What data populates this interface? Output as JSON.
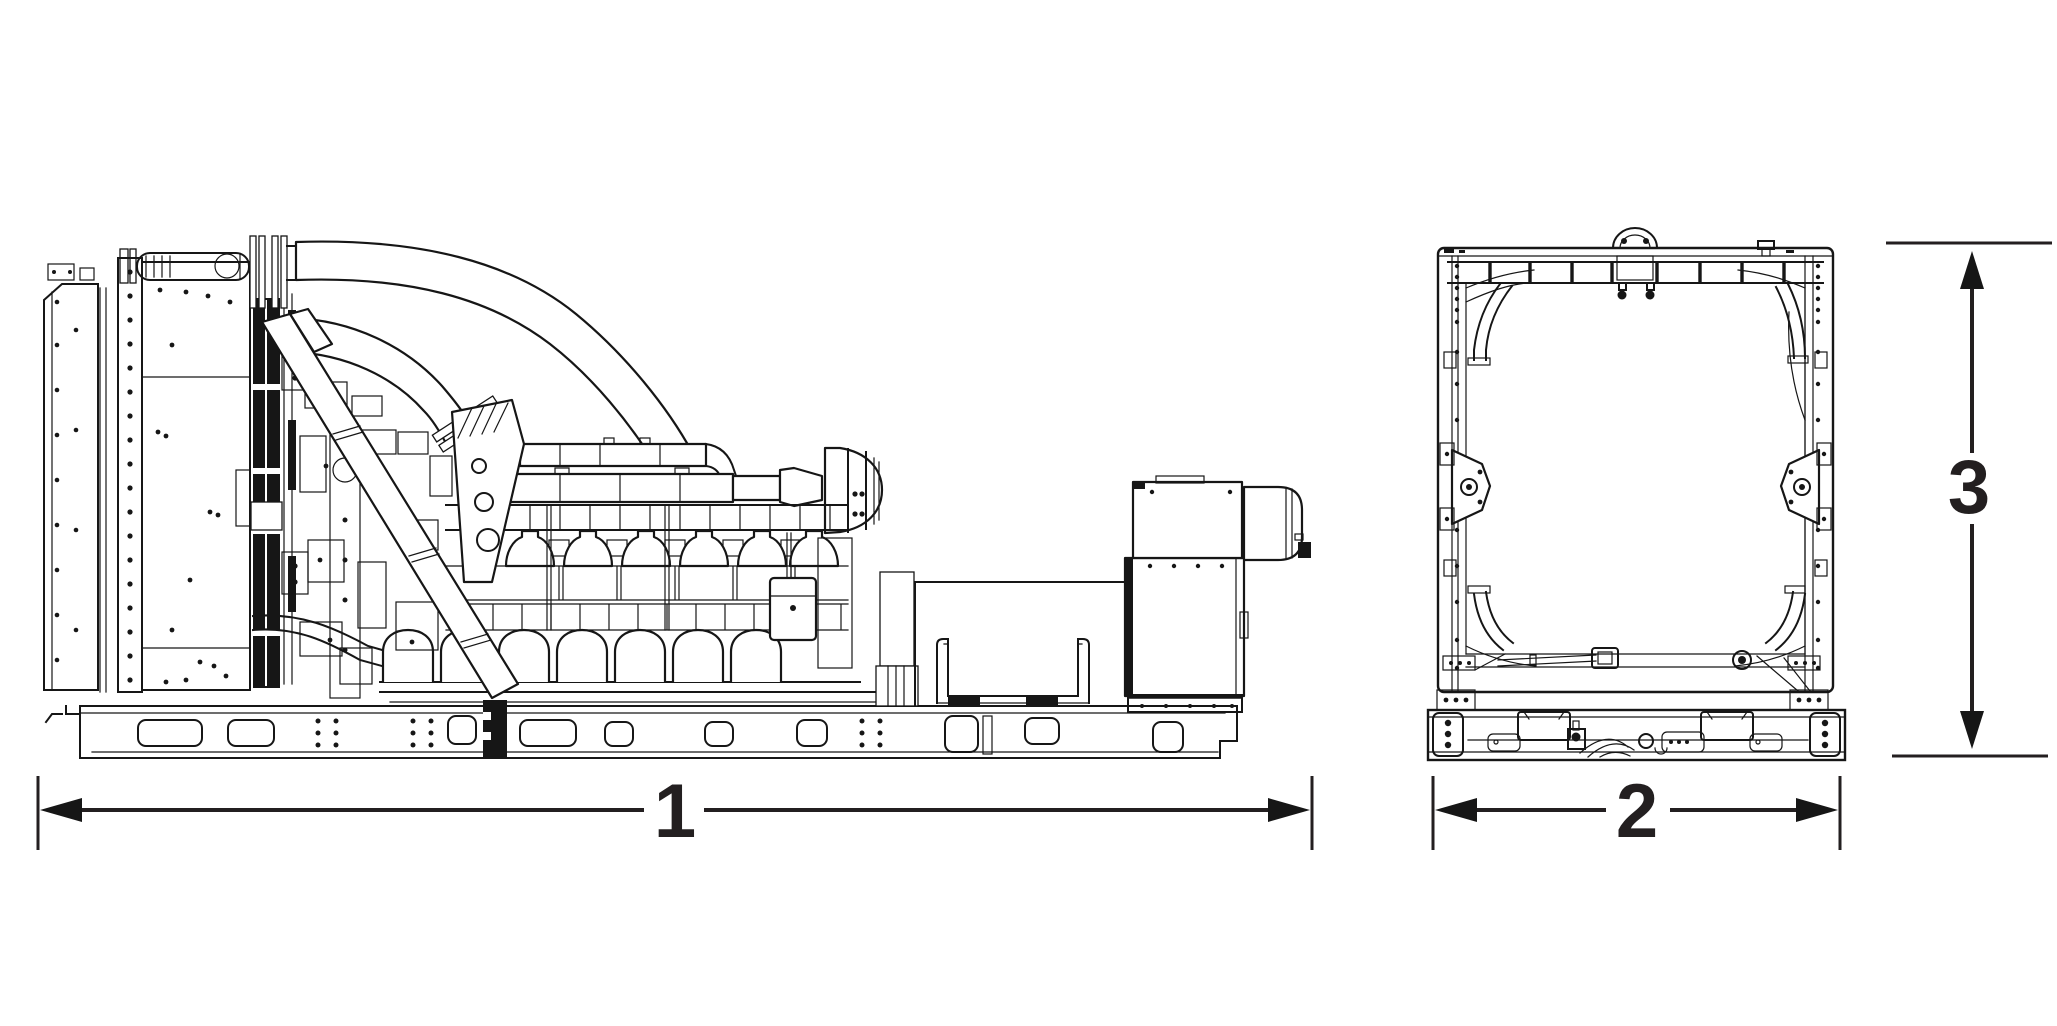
{
  "page": {
    "background_color": "#ffffff",
    "line_color": "#161616"
  },
  "drawing": {
    "views": [
      {
        "id": "side-view",
        "name": "generator-set-side-elevation"
      },
      {
        "id": "end-view",
        "name": "generator-set-end-elevation"
      }
    ],
    "dimensions": [
      {
        "id": "dim-1",
        "label": "1",
        "orientation": "horizontal",
        "view": "side-view",
        "measures": "overall-length"
      },
      {
        "id": "dim-2",
        "label": "2",
        "orientation": "horizontal",
        "view": "end-view",
        "measures": "overall-width"
      },
      {
        "id": "dim-3",
        "label": "3",
        "orientation": "vertical",
        "view": "end-view",
        "measures": "overall-height"
      }
    ]
  }
}
